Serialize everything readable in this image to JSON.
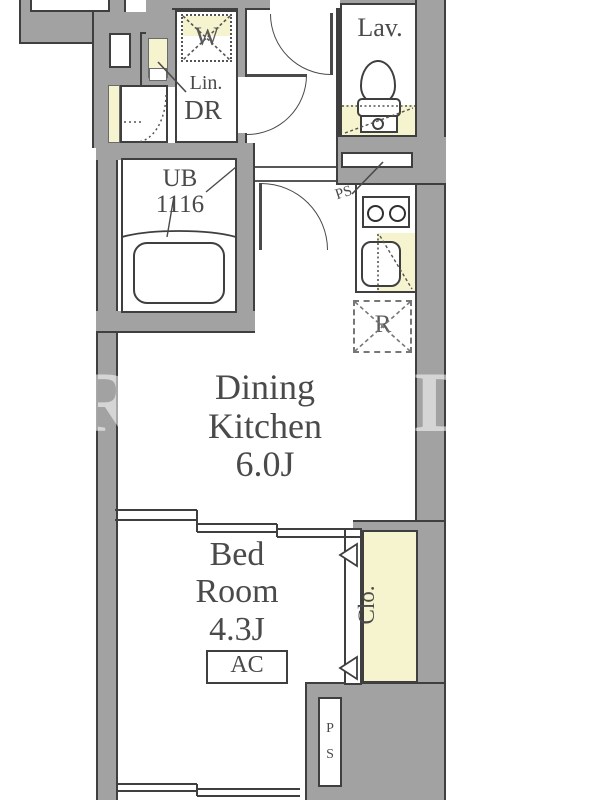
{
  "plan": {
    "title": "1DK apartment floor plan",
    "rooms": {
      "lavatory": {
        "label": "Lav."
      },
      "washer_space": {
        "label": "W"
      },
      "linen": {
        "label": "Lin."
      },
      "dressing_room": {
        "label": "DR"
      },
      "unit_bath": {
        "label": "UB",
        "size_label": "1116"
      },
      "pipe_space_top": {
        "label": "PS"
      },
      "refrigerator": {
        "label": "R"
      },
      "dining_kitchen": {
        "name_line1": "Dining",
        "name_line2": "Kitchen",
        "size": "6.0J"
      },
      "bedroom": {
        "name_line1": "Bed",
        "name_line2": "Room",
        "size": "4.3J"
      },
      "air_conditioner": {
        "label": "AC"
      },
      "closet": {
        "label": "Clo."
      },
      "pipe_space_bottom": {
        "letters": [
          "P",
          "S"
        ]
      }
    },
    "watermark": {
      "left_letter": "R",
      "right_letter": "D"
    },
    "colors": {
      "wall": "#a2a2a2",
      "outline": "#3f3f3f",
      "accent_yellow": "#f6f3cf",
      "text": "#4a4a4a"
    }
  }
}
